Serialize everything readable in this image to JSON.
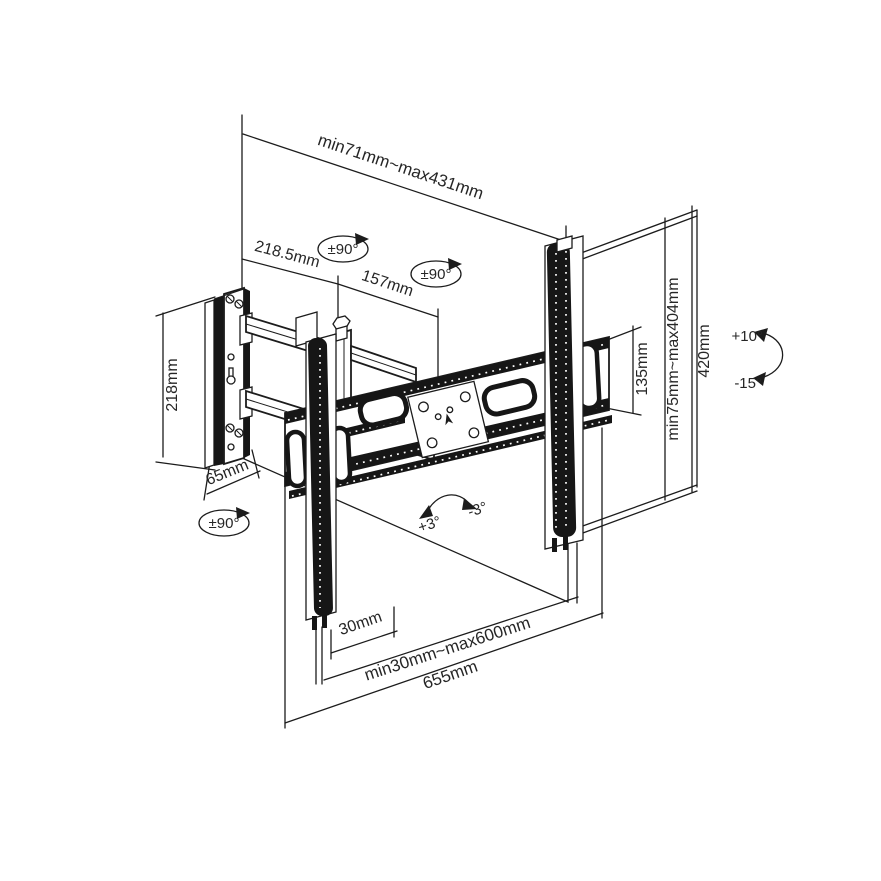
{
  "page": {
    "background": "#ffffff",
    "ink": "#1c1c1c"
  },
  "diagram": {
    "type": "isometric technical line drawing",
    "subject": "full-motion articulating TV wall mount bracket with dimension annotations",
    "labels": {
      "extension_range": "min71mm~max431mm",
      "arm_segment": "218.5mm",
      "arm_offset": "157mm",
      "swivel": "±90°",
      "wall_plate_height": "218mm",
      "wall_plate_depth": "65mm",
      "bracket_profile_height": "135mm",
      "vesa_height_range": "min75mm~max404mm",
      "rail_height": "420mm",
      "tilt_up": "+10°",
      "tilt_down": "-15°",
      "roll_plus": "+3°",
      "roll_minus": "-3°",
      "rail_bottom_offset": "30mm",
      "vesa_width_range": "min30mm~max600mm",
      "crossbar_length": "655mm"
    }
  }
}
